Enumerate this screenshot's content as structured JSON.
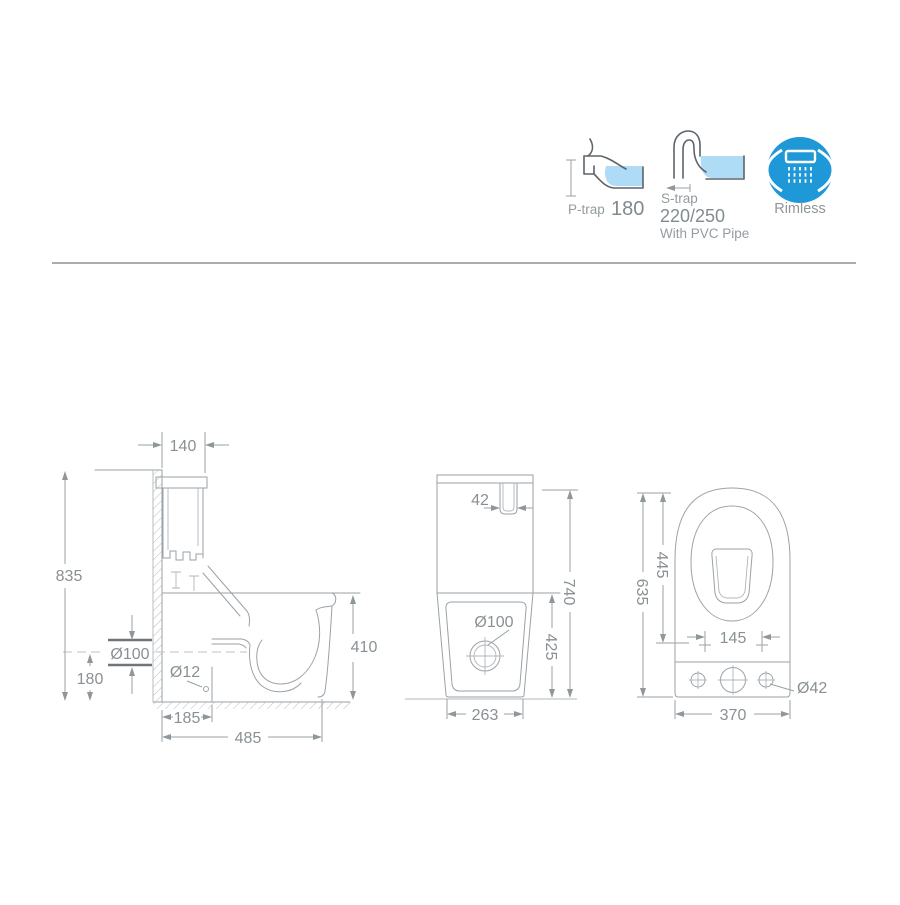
{
  "header": {
    "p_trap": {
      "label": "P-trap",
      "value": "180"
    },
    "s_trap": {
      "label": "S-trap",
      "value": "220/250",
      "note": "With PVC Pipe"
    },
    "rimless": {
      "label": "Rimless"
    }
  },
  "side_view": {
    "tank_depth": "140",
    "total_height": "835",
    "outlet_diameter": "Ø100",
    "outlet_center_height": "180",
    "fixing_hole_diameter": "Ø12",
    "outlet_setout": "185",
    "total_depth": "485",
    "rim_height": "410"
  },
  "front_view": {
    "button_slot_width": "42",
    "total_height": "740",
    "rim_height": "425",
    "outlet_diameter": "Ø100",
    "base_width": "263"
  },
  "top_view": {
    "total_length": "635",
    "seat_opening_length": "445",
    "seat_hole_spacing": "145",
    "width": "370",
    "fixing_hole_diameter": "Ø42"
  },
  "colors": {
    "water_blue": "#aedcf6",
    "rimless_blue": "#1e98d6",
    "line_gray": "#9ba2a7",
    "text_gray": "#899094"
  }
}
